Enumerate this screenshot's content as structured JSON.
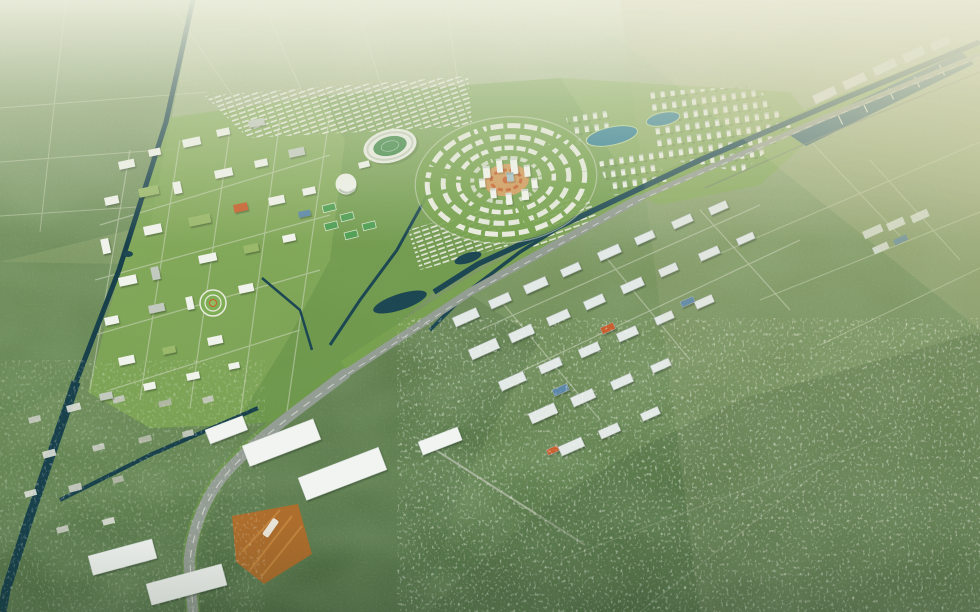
{
  "scene": {
    "type": "aerial-masterplan-render",
    "description": "Bird's-eye architectural rendering of a planned green city (circular central district, stadium, campus blocks, twin lakes, harbor marina) beside an existing industrial park and village sprawl, crossed diagonally by a highway-and-canal corridor, surrounded by forest with atmospheric haze toward the horizon",
    "no_visible_text": true
  },
  "palette": {
    "haze_top": "#e9ebd9",
    "haze_warm": "#d9d0a0",
    "forest_left": "#5e8050",
    "forest_dark": "#4e6b43",
    "planned_green": "#82ab54",
    "park_green": "#6d9c47",
    "ring_green": "#76a14d",
    "water_canal": "#17404b",
    "water_corridor": "#1c4752",
    "water_lake": "#2f7e95",
    "water_harbor": "#27596b",
    "road_grey": "#949d93",
    "road_light": "#d8ddcc",
    "building_white": "#f0f2ec",
    "building_grey": "#c2c9bf",
    "roof_green": "#9ab86a",
    "accent_orange": "#c75f2d",
    "plaza_tan": "#d19a5a",
    "dirt_orange": "#ad6d2c",
    "warehouse_white": "#e3e9e6",
    "roof_blue": "#5b87a8",
    "shed_white": "#f1f4f1",
    "town_grey": "#c6c9bf",
    "field_green": "#3f8748"
  },
  "features": [
    "forest",
    "left-boundary-canal",
    "highway-canal-corridor",
    "central-circular-district",
    "orange-central-plaza",
    "high-rise-towers",
    "stadium",
    "sports-arena",
    "sports-courts",
    "campus-district",
    "row-housing",
    "twin-lakes",
    "tower-clusters",
    "harbor-marina",
    "industrial-park",
    "logistics-sheds",
    "construction-site",
    "old-town",
    "village-sprawl"
  ]
}
